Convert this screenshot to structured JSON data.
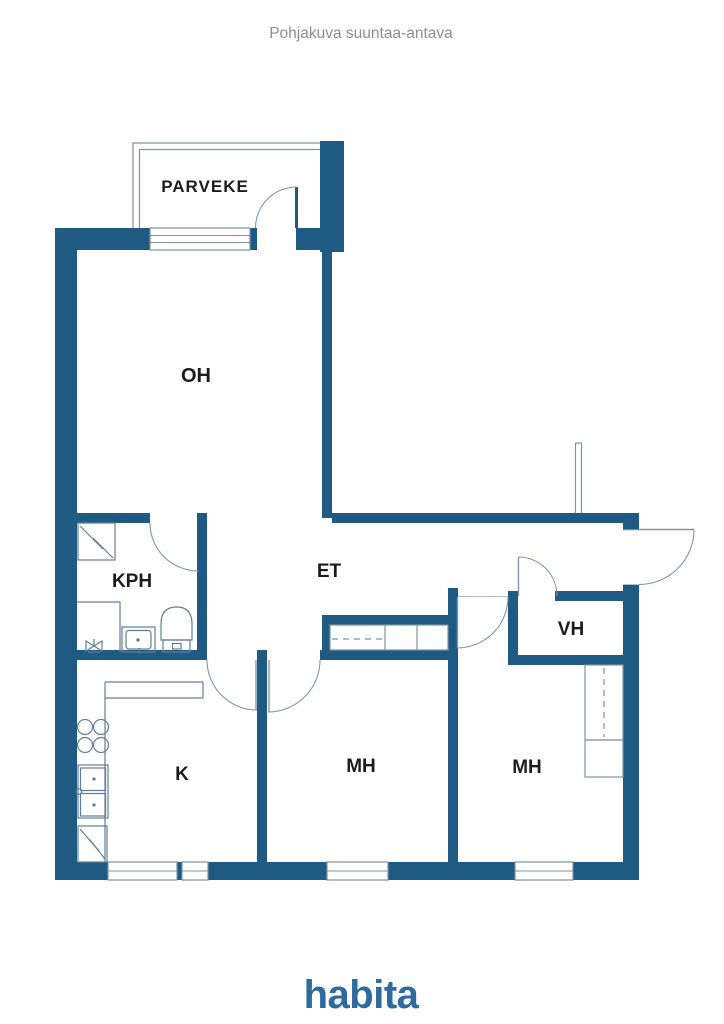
{
  "header": {
    "title": "Pohjakuva suuntaa-antava"
  },
  "rooms": {
    "parveke": "PARVEKE",
    "oh": "OH",
    "kph": "KPH",
    "et": "ET",
    "vh": "VH",
    "k": "K",
    "mh1": "MH",
    "mh2": "MH"
  },
  "brand": {
    "logo": "habita"
  },
  "colors": {
    "wall": "#1E5A82",
    "thin_line": "#7D93A3",
    "fixture_line": "#5F7F97",
    "label_text": "#1C1C1C",
    "title_text": "#8E8E8E",
    "brand_blue": "#2C6AA0",
    "background": "#FFFFFF"
  }
}
